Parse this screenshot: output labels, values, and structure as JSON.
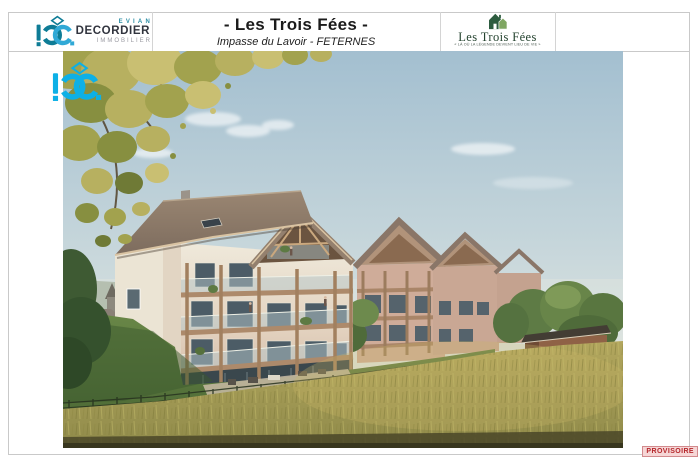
{
  "header": {
    "brand": {
      "region": "EVIAN",
      "name": "DECORDIER",
      "sector": "IMMOBILIER"
    },
    "title": {
      "main": "- Les Trois Fées -",
      "subtitle": "Impasse du Lavoir - FETERNES"
    },
    "program_logo": {
      "name": "Les Trois Fées",
      "tagline": "« LÀ OÙ LA LÉGENDE DEVIENT LIEU DE VIE »"
    }
  },
  "stamp": {
    "label": "PROVISOIRE"
  },
  "icons": {
    "brand_monogram": "dc-monogram-icon",
    "watermark": "dc-watermark-icon",
    "program_house": "house-icon"
  },
  "colors": {
    "brand_teal": "#0e7c96",
    "brand_blue": "#31a9d6",
    "watermark_cyan": "#0db0e6",
    "program_green_dark": "#2d5c3f",
    "program_green_light": "#7fa662",
    "stamp_red": "#b5282c"
  }
}
